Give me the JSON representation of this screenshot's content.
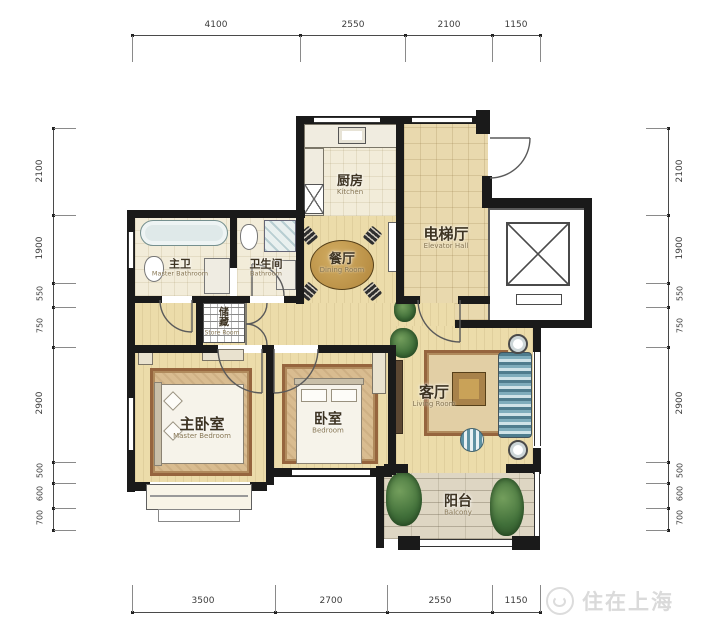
{
  "watermark": {
    "text": "住在上海",
    "logo": "circle-swirl-logo"
  },
  "dimensions": {
    "top": [
      "4100",
      "2550",
      "2100",
      "1150"
    ],
    "bottom": [
      "3500",
      "2700",
      "2550",
      "1150"
    ],
    "left": [
      "2100",
      "1900",
      "550",
      "750",
      "2900",
      "500",
      "600",
      "700"
    ],
    "right": [
      "2100",
      "1900",
      "550",
      "750",
      "2900",
      "500",
      "600",
      "700"
    ]
  },
  "rooms": {
    "kitchen": {
      "name_zh": "厨房",
      "name_en": "Kitchen"
    },
    "elevator_hall": {
      "name_zh": "电梯厅",
      "name_en": "Elevator Hall"
    },
    "dining_room": {
      "name_zh": "餐厅",
      "name_en": "Dining Room"
    },
    "master_bathroom": {
      "name_zh": "主卫",
      "name_en": "Master Bathroom"
    },
    "bathroom": {
      "name_zh": "卫生间",
      "name_en": "Bathroom"
    },
    "store_room": {
      "name_zh": "储藏",
      "name_en": "Store Room"
    },
    "master_bedroom": {
      "name_zh": "主卧室",
      "name_en": "Master Bedroom"
    },
    "bedroom": {
      "name_zh": "卧室",
      "name_en": "Bedroom"
    },
    "living_room": {
      "name_zh": "客厅",
      "name_en": "Living Room"
    },
    "balcony": {
      "name_zh": "阳台",
      "name_en": "Balcony"
    }
  },
  "colors": {
    "wall": "#1a1a1a",
    "wood_floor": "#ecdcaa",
    "tile_floor": "#f2ecd9",
    "hall_floor": "#e9d9ae",
    "balcony_floor": "#ded6c3",
    "rug": "#96653e",
    "sofa_accent": "#4f7d8e",
    "dimension_text": "#3c3c3c",
    "watermark": "#dadada"
  }
}
